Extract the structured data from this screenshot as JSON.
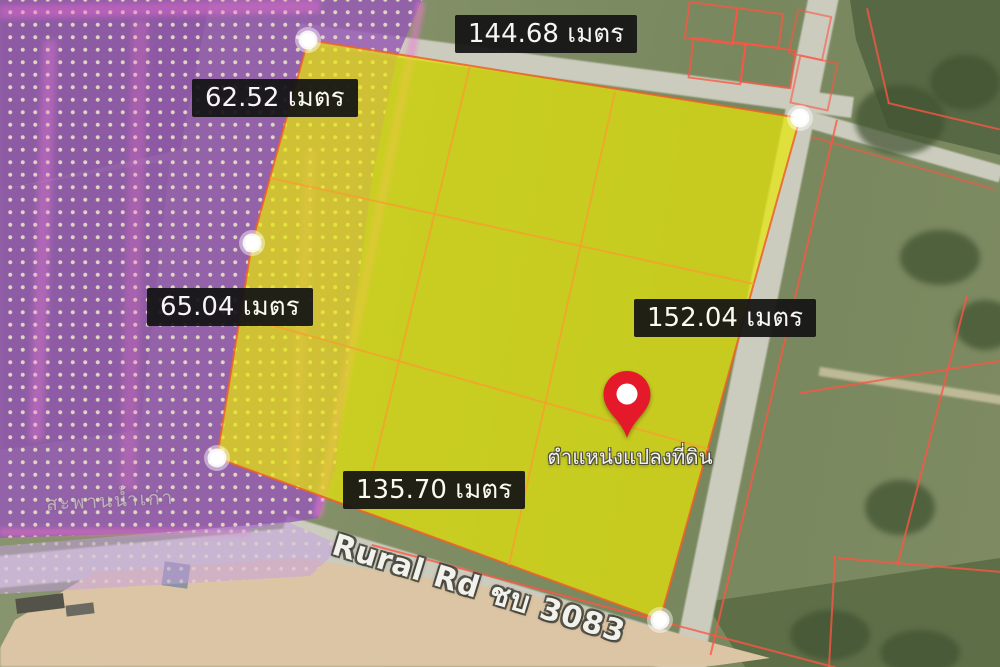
{
  "map": {
    "measurements": {
      "top": "144.68 เมตร",
      "upper_left": "62.52 เมตร",
      "lower_left": "65.04 เมตร",
      "right": "152.04 เมตร",
      "bottom": "135.70 เมตร"
    },
    "pin_caption": "ตำแหน่งแปลงที่ดิน",
    "road_label": "Rural Rd ชบ 3083",
    "faint_place_label": "สะพานน้ำเก่า",
    "colors": {
      "plot_fill": "#e8e806",
      "plot_outline": "#f05f28",
      "zoning_purple": "#9658b6",
      "cadastral_red": "#ff5442",
      "pin_red": "#e41a2b",
      "label_bg": "#141414",
      "label_text": "#ffffff"
    }
  }
}
